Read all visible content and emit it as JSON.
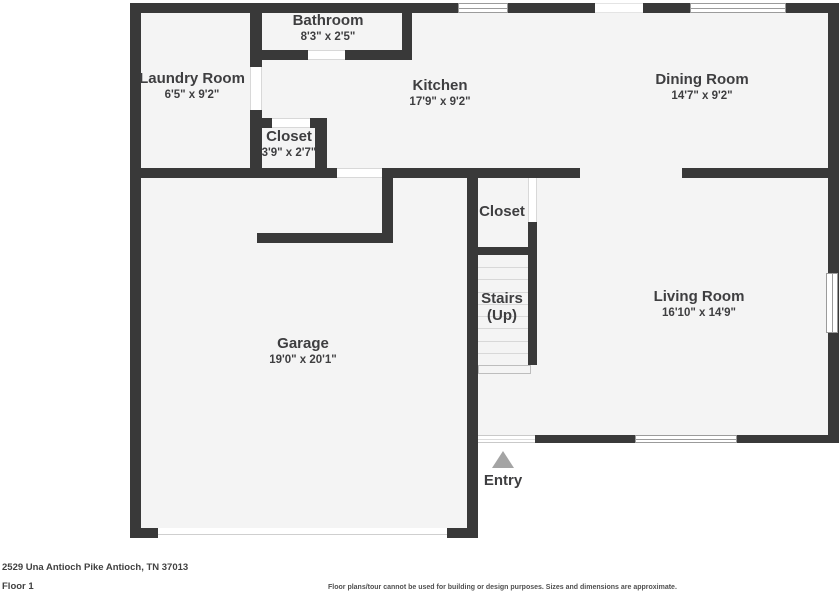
{
  "colors": {
    "wall": "#393939",
    "floor_fill": "#f4f4f4",
    "background": "#ffffff",
    "label_text": "#3e3e40",
    "window_frame": "#9b9b9b",
    "entry_arrow": "#a4a4a4",
    "tread_line": "#d8d8d8"
  },
  "floorplan": {
    "footprint": [
      {
        "x": 130,
        "y": 3,
        "w": 348,
        "h": 535
      },
      {
        "x": 467,
        "y": 3,
        "w": 372,
        "h": 440
      }
    ],
    "walls": [
      {
        "x": 130,
        "y": 3,
        "w": 709,
        "h": 10
      },
      {
        "x": 130,
        "y": 3,
        "w": 11,
        "h": 535
      },
      {
        "x": 130,
        "y": 528,
        "w": 28,
        "h": 10
      },
      {
        "x": 447,
        "y": 528,
        "w": 31,
        "h": 10
      },
      {
        "x": 467,
        "y": 168,
        "w": 11,
        "h": 370
      },
      {
        "x": 478,
        "y": 435,
        "w": 7,
        "h": 8
      },
      {
        "x": 535,
        "y": 435,
        "w": 101,
        "h": 8
      },
      {
        "x": 737,
        "y": 435,
        "w": 102,
        "h": 8
      },
      {
        "x": 828,
        "y": 3,
        "w": 11,
        "h": 440
      },
      {
        "x": 130,
        "y": 168,
        "w": 207,
        "h": 10
      },
      {
        "x": 382,
        "y": 168,
        "w": 198,
        "h": 10
      },
      {
        "x": 682,
        "y": 168,
        "w": 157,
        "h": 10
      },
      {
        "x": 250,
        "y": 3,
        "w": 12,
        "h": 64
      },
      {
        "x": 250,
        "y": 110,
        "w": 12,
        "h": 60
      },
      {
        "x": 250,
        "y": 50,
        "w": 58,
        "h": 10
      },
      {
        "x": 345,
        "y": 50,
        "w": 67,
        "h": 10
      },
      {
        "x": 402,
        "y": 3,
        "w": 10,
        "h": 57
      },
      {
        "x": 250,
        "y": 118,
        "w": 22,
        "h": 10
      },
      {
        "x": 310,
        "y": 118,
        "w": 17,
        "h": 10
      },
      {
        "x": 315,
        "y": 118,
        "w": 12,
        "h": 52
      },
      {
        "x": 382,
        "y": 168,
        "w": 11,
        "h": 75
      },
      {
        "x": 257,
        "y": 233,
        "w": 136,
        "h": 10
      },
      {
        "x": 528,
        "y": 222,
        "w": 9,
        "h": 143
      },
      {
        "x": 478,
        "y": 247,
        "w": 50,
        "h": 8
      }
    ],
    "openings": [
      {
        "kind": "window",
        "x": 458,
        "y": 3,
        "w": 50,
        "h": 10
      },
      {
        "kind": "gap",
        "x": 595,
        "y": 3,
        "w": 48,
        "h": 10
      },
      {
        "kind": "window",
        "x": 690,
        "y": 3,
        "w": 96,
        "h": 10
      },
      {
        "kind": "door",
        "x": 308,
        "y": 50,
        "w": 37,
        "h": 10
      },
      {
        "kind": "door",
        "x": 250,
        "y": 67,
        "w": 12,
        "h": 43
      },
      {
        "kind": "door",
        "x": 272,
        "y": 118,
        "w": 38,
        "h": 10
      },
      {
        "kind": "door",
        "x": 337,
        "y": 168,
        "w": 45,
        "h": 10
      },
      {
        "kind": "door",
        "x": 528,
        "y": 178,
        "w": 9,
        "h": 44
      },
      {
        "kind": "entry-door",
        "x": 478,
        "y": 435,
        "w": 57,
        "h": 8
      },
      {
        "kind": "window",
        "x": 635,
        "y": 435,
        "w": 102,
        "h": 8
      },
      {
        "kind": "window",
        "x": 826,
        "y": 273,
        "w": 12,
        "h": 60
      },
      {
        "kind": "garage-door",
        "x": 158,
        "y": 528,
        "w": 289,
        "h": 10
      }
    ],
    "stairs_box": {
      "x": 478,
      "y": 255,
      "w": 50,
      "h": 110,
      "treads": 9,
      "landing": {
        "x": 478,
        "y": 365,
        "w": 53,
        "h": 9
      }
    },
    "rooms": [
      {
        "id": "bathroom",
        "name": "Bathroom",
        "dims": "8'3\" x 2'5\"",
        "cx": 328,
        "top": 12
      },
      {
        "id": "laundry-room",
        "name": "Laundry Room",
        "dims": "6'5\" x 9'2\"",
        "cx": 192,
        "top": 70
      },
      {
        "id": "kitchen",
        "name": "Kitchen",
        "dims": "17'9\" x 9'2\"",
        "cx": 440,
        "top": 77
      },
      {
        "id": "dining-room",
        "name": "Dining Room",
        "dims": "14'7\" x 9'2\"",
        "cx": 702,
        "top": 71
      },
      {
        "id": "closet-hall",
        "name": "Closet",
        "dims": "3'9\" x 2'7\"",
        "cx": 289,
        "top": 128
      },
      {
        "id": "closet-stairs",
        "name": "Closet",
        "dims": "",
        "cx": 502,
        "top": 203
      },
      {
        "id": "stairs",
        "name": "Stairs",
        "dims": "(Up)",
        "cx": 502,
        "top": 290,
        "large_sub": true
      },
      {
        "id": "living-room",
        "name": "Living Room",
        "dims": "16'10\" x 14'9\"",
        "cx": 699,
        "top": 288
      },
      {
        "id": "garage",
        "name": "Garage",
        "dims": "19'0\" x 20'1\"",
        "cx": 303,
        "top": 335
      },
      {
        "id": "entry",
        "name": "Entry",
        "dims": "",
        "cx": 503,
        "top": 472
      }
    ],
    "entry_arrow": {
      "cx": 503,
      "y": 451,
      "half_w": 11,
      "h": 17
    }
  },
  "footer": {
    "address": "2529 Una Antioch Pike Antioch, TN 37013",
    "floor_label": "Floor 1",
    "disclaimer": "Floor plans/tour cannot be used for building or design purposes. Sizes and dimensions are approximate."
  }
}
